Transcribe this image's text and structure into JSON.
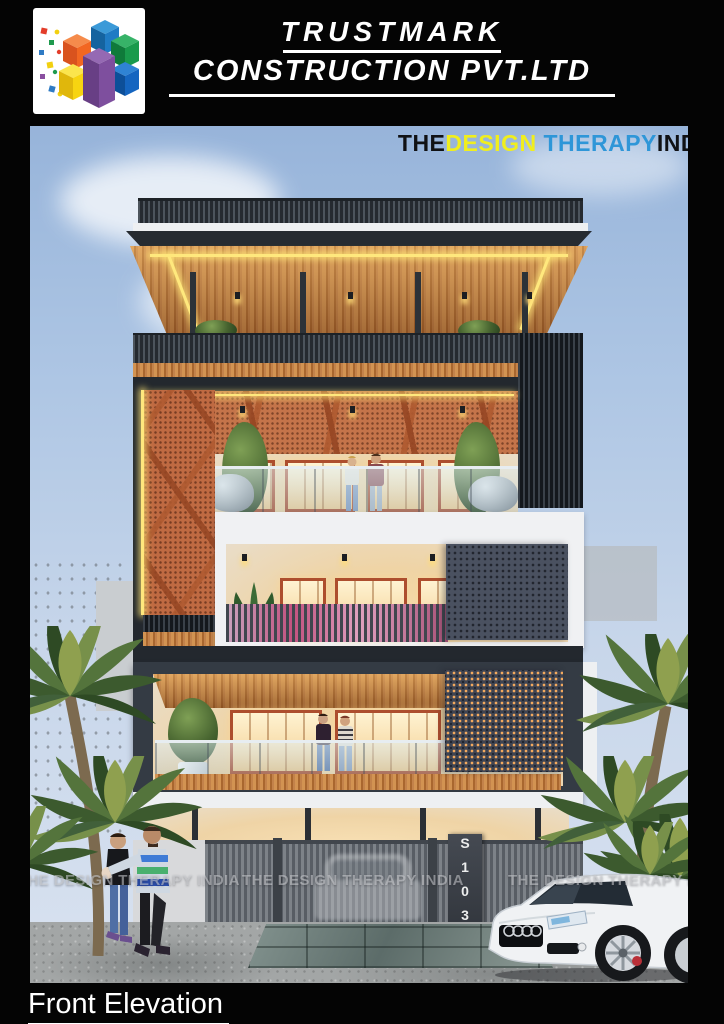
{
  "header": {
    "logo_icon": "colorful-cubes-logo",
    "title_line1": "TRUSTMARK",
    "title_line2": "CONSTRUCTION PVT.LTD"
  },
  "brand_watermark": {
    "part_the": "THE",
    "part_design": "DESIGN",
    "part_therapy": " THERAPY",
    "part_india": "INDIA"
  },
  "scene_watermarks": [
    "THE DESIGN THERAPY INDIA",
    "THE DESIGN THERAPY INDIA",
    "THE DESIGN THERAPY INDIA"
  ],
  "building": {
    "house_number_plate": "S103"
  },
  "footer": {
    "caption": "Front Elevation"
  },
  "palette": {
    "page_background": "#040404",
    "sky_top": "#97b4da",
    "sky_bottom": "#d9e2f0",
    "wood_slats": "#c3824a",
    "terracotta_jali": "#bf6a42",
    "charcoal_frame": "#2b3036",
    "led_accent": "#ffe87d",
    "white_band": "#eef0f2",
    "brand_yellow": "#f0ee1e",
    "brand_blue": "#2e96d8",
    "magenta_rail_glow": "#c2527f",
    "window_frame": "#ad4e2e"
  }
}
